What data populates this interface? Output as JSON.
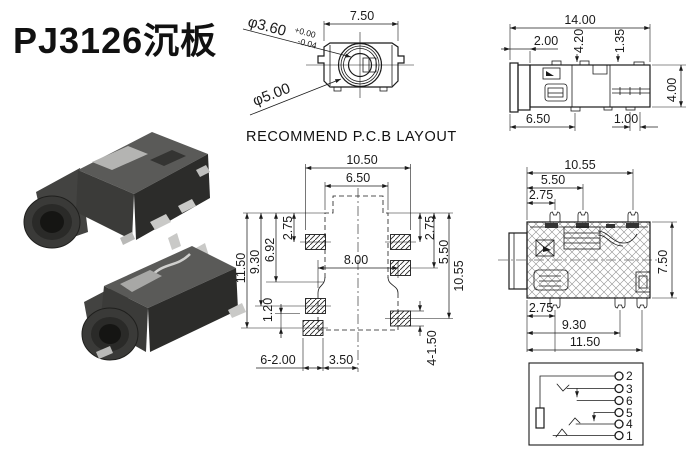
{
  "title": "PJ3126沉板",
  "colors": {
    "background": "#ffffff",
    "line": "#1b1b1b",
    "photo_body": "#3b3b39",
    "photo_metal": "#b4b4b2"
  },
  "front_view": {
    "dim_width": "7.50",
    "dia_inner_label": "φ3.60",
    "dia_inner_tol_plus": "+0.00",
    "dia_inner_tol_minus": "-0.04",
    "dia_outer_label": "φ5.00"
  },
  "side_view": {
    "dim_total_width": "14.00",
    "dim_cap": "2.00",
    "dim_pin_a": "4.20",
    "dim_pin_b": "1.35",
    "dim_height": "4.00",
    "dim_bottom_left": "6.50",
    "dim_bottom_right": "1.00"
  },
  "pcb_layout": {
    "heading": "RECOMMEND P.C.B LAYOUT",
    "dim_pad_span": "10.50",
    "dim_body_width": "6.50",
    "dim_left_top": "2.75",
    "dim_left_step": "6.92",
    "dim_left_mid": "9.30",
    "dim_left_total": "11.50",
    "dim_right_top": "2.75",
    "dim_right_mid": "5.50",
    "dim_right_low": "10.55",
    "dim_center_width": "8.00",
    "dim_pad_gap": "1.20",
    "dim_pad_width": "6-2.00",
    "dim_center_offset": "3.50",
    "dim_pad_height": "4-1.50"
  },
  "section_view": {
    "dim_top_full": "10.55",
    "dim_top_mid": "5.50",
    "dim_top_first": "2.75",
    "dim_height": "7.50",
    "dim_bot_first": "2.75",
    "dim_bot_mid": "9.30",
    "dim_bot_full": "11.50"
  },
  "schematic": {
    "pins": [
      "2",
      "3",
      "6",
      "5",
      "4",
      "1"
    ]
  }
}
